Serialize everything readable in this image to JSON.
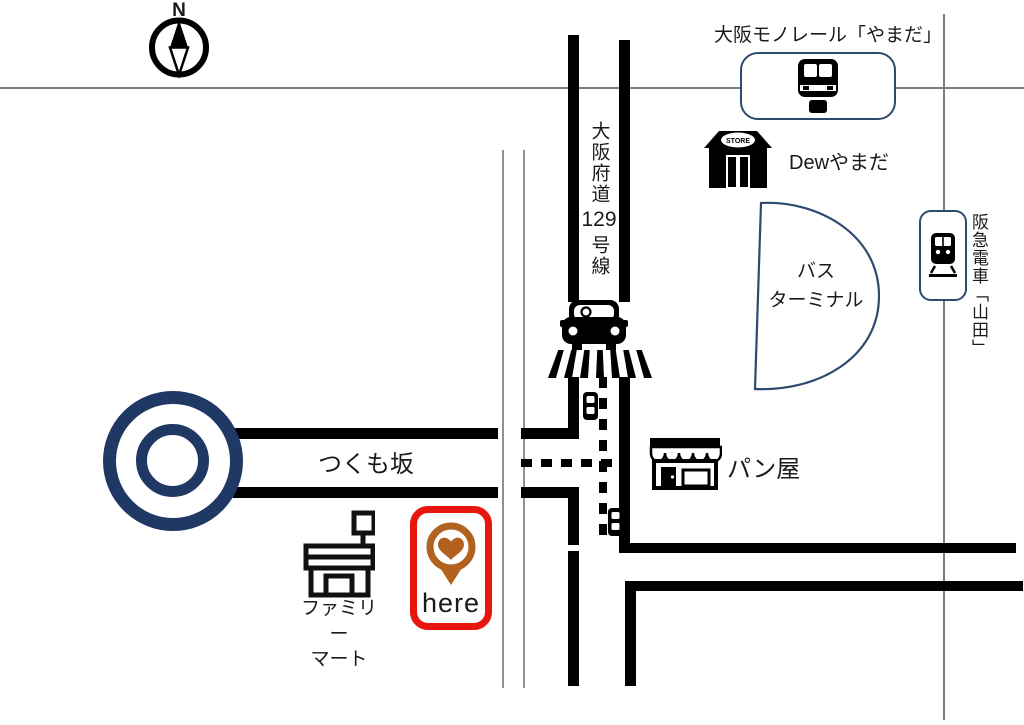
{
  "compass": {
    "label": "N"
  },
  "landmarks": {
    "monorail_station": {
      "label": "大阪モノレール「やまだ」"
    },
    "dew_yamada": {
      "label": "Dewやまだ",
      "awning_text": "STORE"
    },
    "bus_terminal": {
      "label_line1": "バス",
      "label_line2": "ターミナル"
    },
    "hankyu_station": {
      "label": "阪急電車「山田」"
    },
    "bakery": {
      "label": "パン屋"
    },
    "familymart": {
      "label_line1": "ファミリー",
      "label_line2": "マート"
    },
    "destination": {
      "label": "here"
    }
  },
  "roads": {
    "route129": {
      "label_part1": "大阪府道",
      "label_part2": "129",
      "label_part3": "号線"
    },
    "tsukumozaka": {
      "label": "つくも坂"
    }
  },
  "icons": {
    "compass": "compass-north-icon",
    "monorail_train": "monorail-train-icon",
    "dew_store": "store-icon",
    "hankyu_train": "train-front-icon",
    "car": "car-icon",
    "crosswalk": "crosswalk-icon",
    "traffic_light": "traffic-light-icon",
    "roundabout": "roundabout-icon",
    "bakery": "bakery-storefront-icon",
    "familymart": "convenience-store-icon",
    "destination_pin": "heart-map-pin-icon",
    "bus_terminal_area": "bus-terminal-shape"
  },
  "colors": {
    "road_black": "#000000",
    "navy_blue": "#1f3864",
    "outline_navy": "#2e4a6e",
    "marker_red": "#e8160c",
    "pin_brown": "#b2611f",
    "text_dark": "#1a1a1a",
    "gridline_gray": "#7d7d7d"
  }
}
